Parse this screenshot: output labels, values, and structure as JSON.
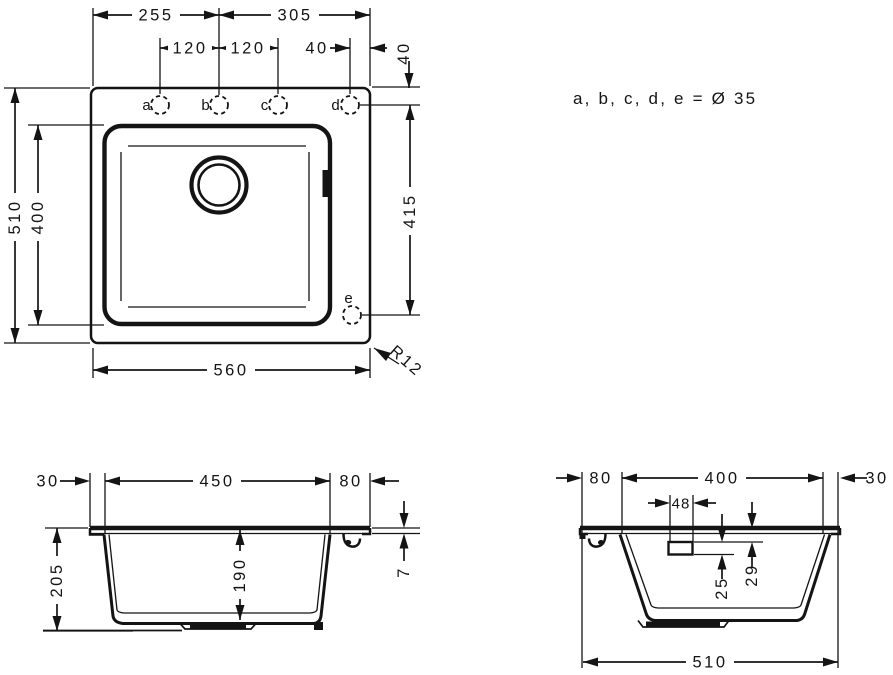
{
  "note": "a, b, c, d, e = Ø 35",
  "plan": {
    "dim_top_left": "255",
    "dim_top_right": "305",
    "dim_hole_ab": "120",
    "dim_hole_bc": "120",
    "dim_hole_d_edge": "40",
    "dim_hole_row_offset": "40",
    "dim_overall_depth": "510",
    "dim_basin_depth": "400",
    "dim_hole_d_e": "415",
    "dim_overall_width": "560",
    "corner_radius": "R12",
    "holes": {
      "a": "a",
      "b": "b",
      "c": "c",
      "d": "d",
      "e": "e"
    }
  },
  "front_section": {
    "dim_left_ledge": "30",
    "dim_basin_width": "450",
    "dim_right_ledge": "80",
    "dim_total_height": "205",
    "dim_basin_height": "190",
    "dim_rim_thickness": "7"
  },
  "side_section": {
    "dim_left_ledge": "80",
    "dim_basin_width": "400",
    "dim_right_ledge": "30",
    "dim_overflow_width": "48",
    "dim_overflow_height": "25",
    "dim_overflow_offset": "29",
    "dim_overall_width": "510"
  },
  "colors": {
    "line": "#141414",
    "background": "#ffffff"
  }
}
